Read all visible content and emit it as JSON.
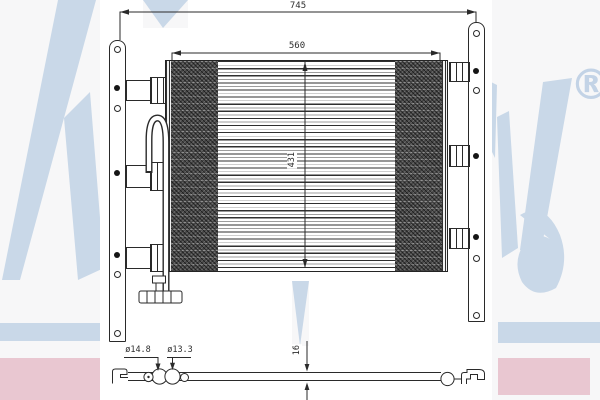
{
  "watermark": {
    "brand": "Nissens",
    "registered_mark": "®",
    "color_blue": "#c9d8e8",
    "color_pink": "#e9c7d1"
  },
  "dimensions": {
    "overall_width": "745",
    "core_width": "560",
    "core_height": "431",
    "fitting_diameter_large": "ø14.8",
    "fitting_diameter_small": "ø13.3",
    "profile_height": "16"
  },
  "line_color": "#2a2a2a"
}
